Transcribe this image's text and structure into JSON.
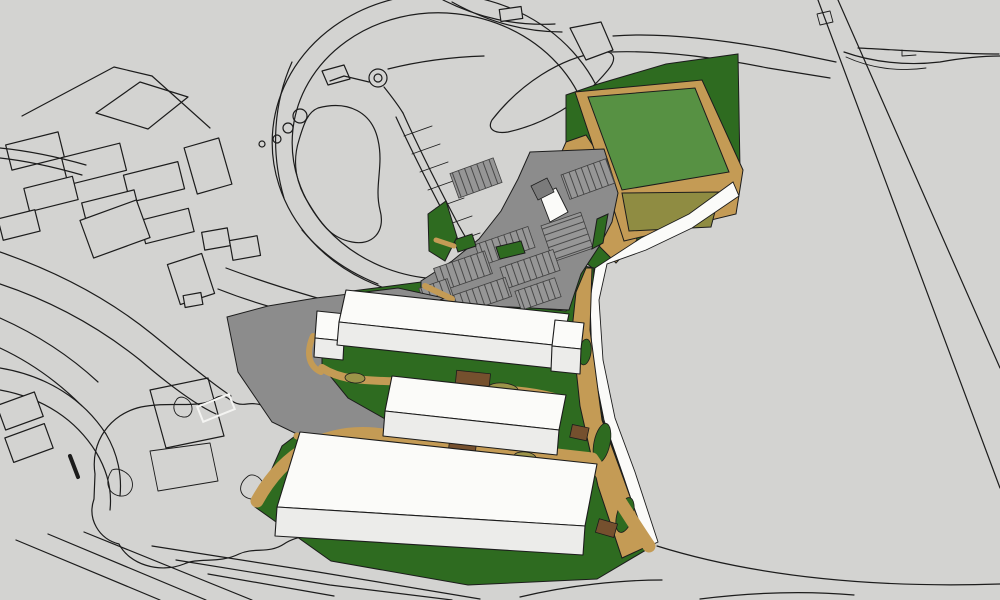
{
  "viewport": {
    "kind": "3d-architectural-site-model-aerial-view",
    "width_px": 1000,
    "height_px": 600
  },
  "colors": {
    "bg": "#D3D3D1",
    "line": "#1C1C1C",
    "road_gray": "#8C8C8C",
    "road_gray_dark": "#7B7B7B",
    "stall_bg": "#969696",
    "stall_line": "#3F3F3F",
    "lawn_green": "#2E6B20",
    "pitch_green": "#579143",
    "olive_green": "#8F8C42",
    "tan": "#C49B55",
    "brown": "#75502E",
    "khaki": "#9C9449",
    "white_road": "#FBFBF9",
    "bldg_top": "#FBFBF9",
    "bldg_front": "#ECECEA",
    "white_marking": "#F4F4F2"
  },
  "scene": {
    "proposed_buildings": {
      "count": 3,
      "color": "white massing blocks",
      "details": [
        "long slab with west annex and rooftop cube at east end",
        "medium slab",
        "large south slab"
      ]
    },
    "sports_pitch": {
      "surface": "light green",
      "border": "tan running path",
      "south_area": "olive green hard surface",
      "surround": "dark green grass"
    },
    "parking_lot": {
      "surface": "dark gray asphalt",
      "stall_rows": 9,
      "landscape_islands": 4,
      "entrance": "white paved wedge from ring road"
    },
    "landscaping": {
      "lawns": "dark green",
      "paths": "tan",
      "tree_blobs_on_east_strip": 3,
      "brown_patches": 4,
      "khaki_patches": 4
    },
    "context_linework": {
      "style": "monochrome outline drawing on gray",
      "ring_road": true,
      "roundabout": true,
      "ponds": 2,
      "tree_circles": 4,
      "slope_hatch_ticks": 7,
      "diagonal_road_east": true,
      "building_clusters": [
        "north-west",
        "west",
        "south-west"
      ]
    }
  }
}
